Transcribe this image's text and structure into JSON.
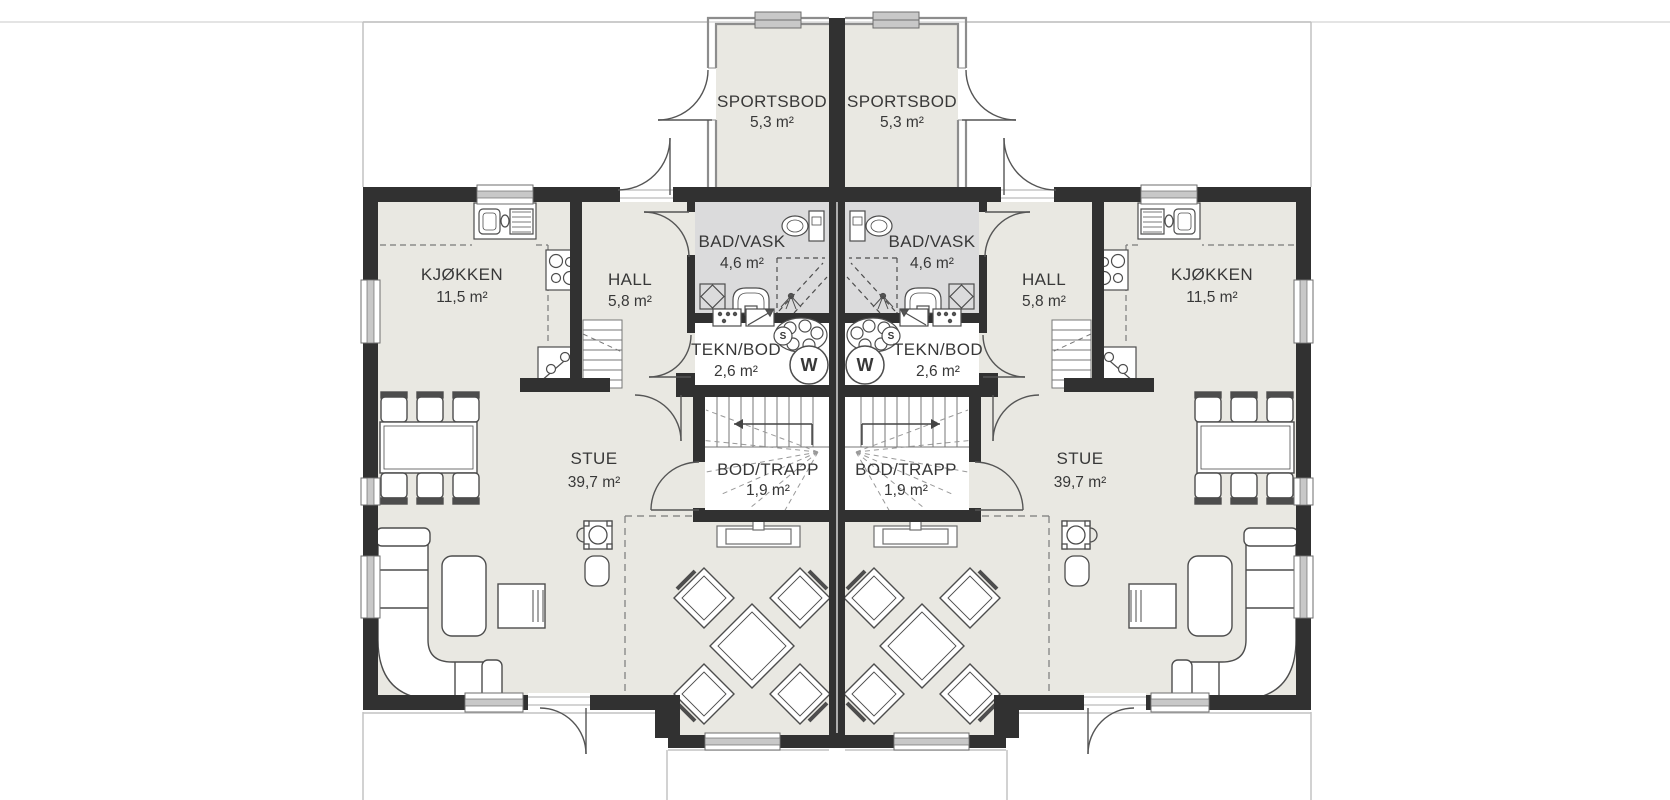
{
  "title": "Duplex first floor plan",
  "colors": {
    "wall": "#313131",
    "floor": "#e9e8e2",
    "bathroom_floor": "#dbdbdc",
    "furniture_line": "#4d4d4d",
    "light_wall": "#8d8d8d",
    "window_fill": "#c8c8c8",
    "terrace_line": "#c2c2c2",
    "text": "#383838"
  },
  "units": [
    {
      "side": "left",
      "rooms": {
        "sportsbod": {
          "name": "SPORTSBOD",
          "area": "5,3 m²"
        },
        "bad_vask": {
          "name": "BAD/VASK",
          "area": "4,6 m²"
        },
        "hall": {
          "name": "HALL",
          "area": "5,8 m²"
        },
        "kjokken": {
          "name": "KJØKKEN",
          "area": "11,5 m²"
        },
        "tekn_bod": {
          "name": "TEKN/BOD",
          "area": "2,6 m²"
        },
        "bod_trapp": {
          "name": "BOD/TRAPP",
          "area": "1,9 m²"
        },
        "stue": {
          "name": "STUE",
          "area": "39,7 m²"
        }
      },
      "appliance_marks": {
        "washing_machine": "W",
        "water_heater": "S"
      }
    },
    {
      "side": "right",
      "rooms": {
        "sportsbod": {
          "name": "SPORTSBOD",
          "area": "5,3 m²"
        },
        "bad_vask": {
          "name": "BAD/VASK",
          "area": "4,6 m²"
        },
        "hall": {
          "name": "HALL",
          "area": "5,8 m²"
        },
        "kjokken": {
          "name": "KJØKKEN",
          "area": "11,5 m²"
        },
        "tekn_bod": {
          "name": "TEKN/BOD",
          "area": "2,6 m²"
        },
        "bod_trapp": {
          "name": "BOD/TRAPP",
          "area": "1,9 m²"
        },
        "stue": {
          "name": "STUE",
          "area": "39,7 m²"
        }
      },
      "appliance_marks": {
        "washing_machine": "W",
        "water_heater": "S"
      }
    }
  ]
}
